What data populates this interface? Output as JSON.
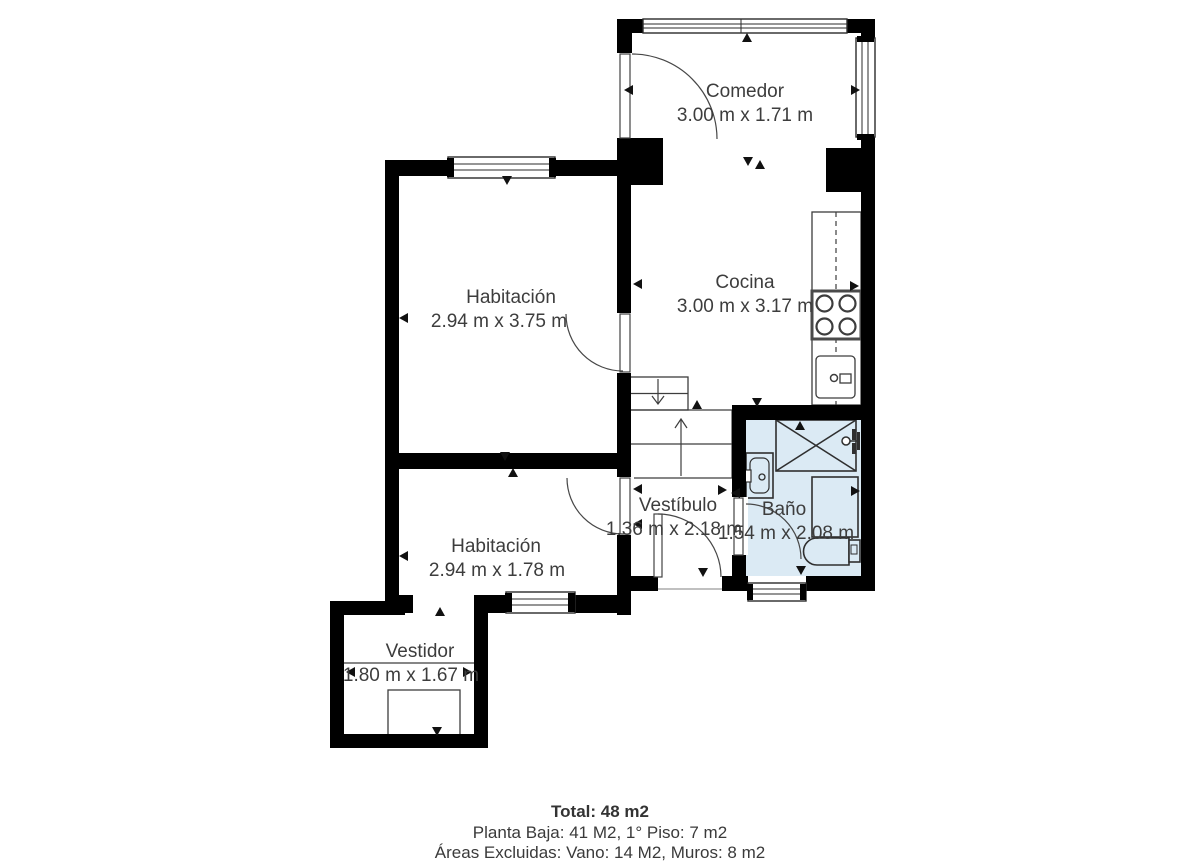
{
  "plan": {
    "rooms": [
      {
        "name": "Comedor",
        "dims": "3.00 m x 1.71 m"
      },
      {
        "name": "Cocina",
        "dims": "3.00 m x 3.17 m"
      },
      {
        "name": "Habitación",
        "dims": "2.94 m x 3.75 m"
      },
      {
        "name": "Habitación",
        "dims": "2.94 m x 1.78 m"
      },
      {
        "name": "Vestíbulo",
        "dims": "1.36 m x 2.18 m"
      },
      {
        "name": "Baño",
        "dims": "1.54 m x 2.08 m"
      },
      {
        "name": "Vestidor",
        "dims": "1.80 m x 1.67 m"
      }
    ],
    "colors": {
      "wall": "#000000",
      "line": "#3d3d3d",
      "bath_fill": "#dbeaf4",
      "text": "#3d3d3d"
    },
    "fixtures": [
      "counter",
      "stove",
      "kitchen-sink",
      "shower",
      "shower-valve",
      "bathroom-sink",
      "washing-machine",
      "toilet",
      "closet",
      "stairs-down",
      "stairs-up"
    ]
  },
  "summary": {
    "total": "Total: 48 m2",
    "floors": "Planta Baja: 41 M2, 1° Piso: 7 m2",
    "excluded": "Áreas Excluidas: Vano: 14 M2, Muros: 8 m2"
  }
}
